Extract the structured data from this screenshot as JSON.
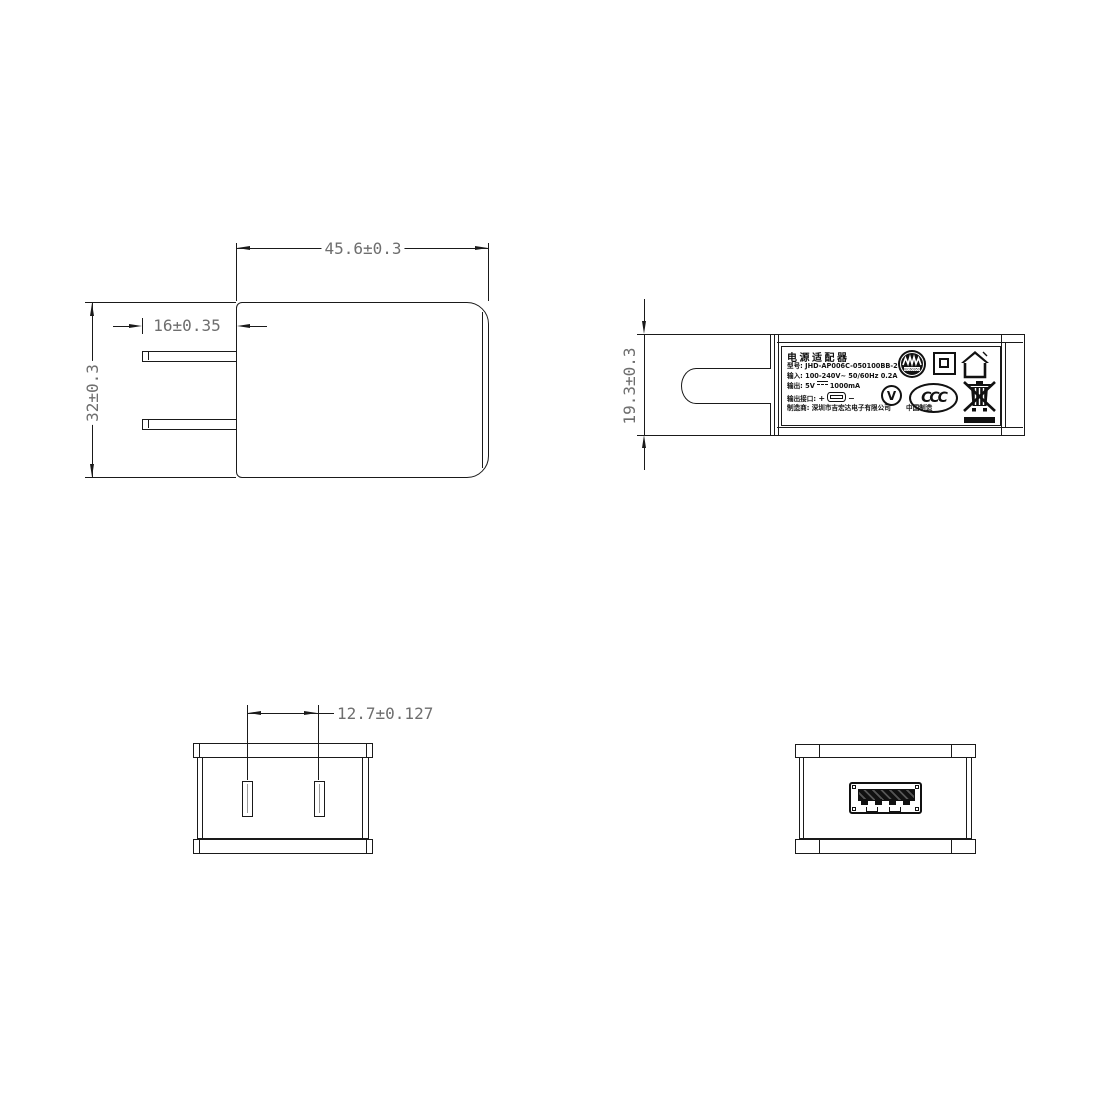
{
  "front_view": {
    "dim_width": "45.6±0.3",
    "dim_prong_length": "16±0.35",
    "dim_height": "32±0.3"
  },
  "side_view": {
    "dim_thickness": "19.3±0.3",
    "label": {
      "title": "电源适配器",
      "model": "型号: JHD-AP006C-050100BB-2",
      "input": "输入: 100-240V~  50/60Hz  0.2A",
      "output_prefix": "输出: 5V",
      "output_current": "1000mA",
      "port_label": "输出接口:",
      "plus": "+",
      "minus": "−",
      "manufacturer": "制造商: 深圳市吉宏达电子有限公司",
      "made_in": "中国制造",
      "ccc_text": "CCC",
      "efficiency_text": "V",
      "cert_circle_text": "IEC60950"
    }
  },
  "top_view": {
    "dim_pin_spacing": "12.7±0.127"
  },
  "colors": {
    "line": "#1a1a1a",
    "dim_text": "#6e6e6e",
    "background": "#ffffff"
  }
}
